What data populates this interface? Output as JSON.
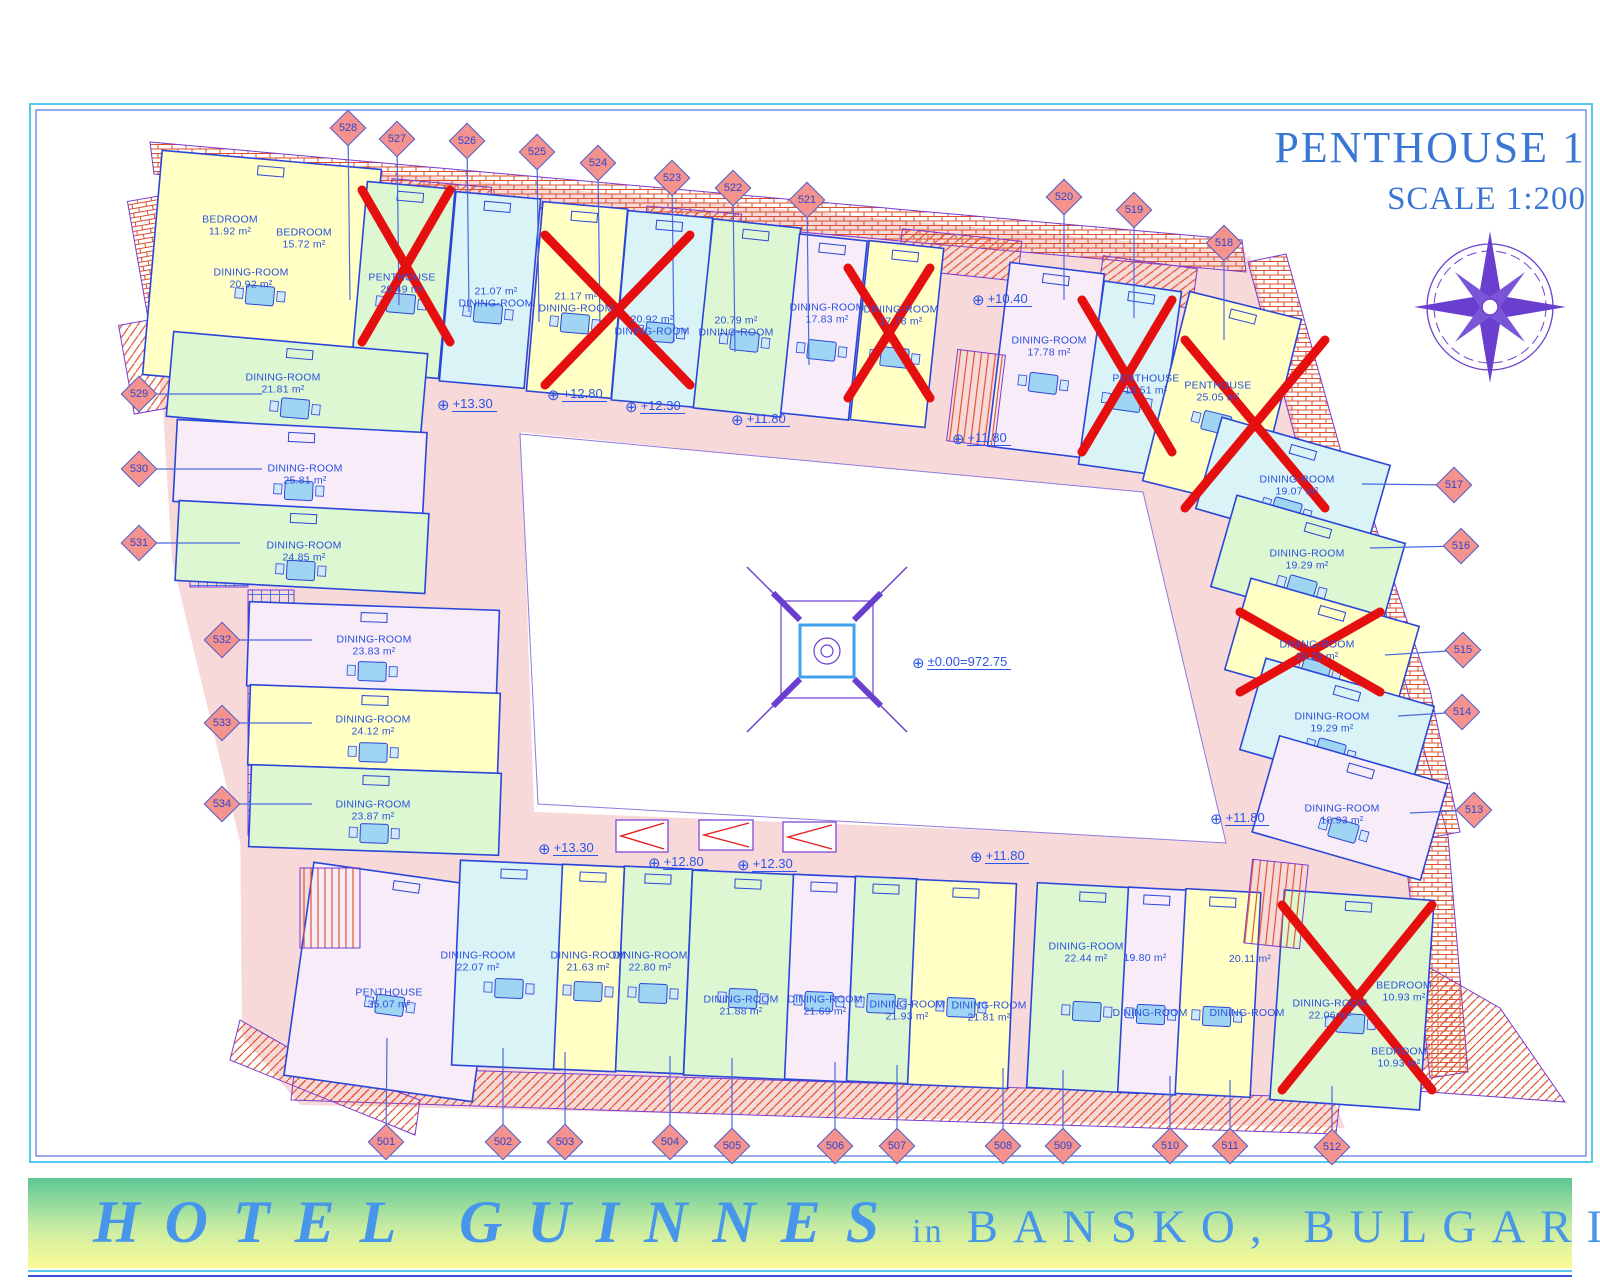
{
  "title": {
    "line1": "PENTHOUSE 1",
    "line2": "SCALE 1:200"
  },
  "banner": {
    "hotel": "HOTEL GUINNES",
    "conj": "in",
    "location": "BANSKO, BULGARIA"
  },
  "colors": {
    "corridor": "#f8d9d9",
    "yellow": "#ffffc6",
    "cyan": "#d9f3f6",
    "green": "#def7d3",
    "lavender": "#f7ecf8",
    "line": "#2a46d8",
    "label": "#2950e0",
    "red_cross": "#e60f0f",
    "roof_line": "#e0542e",
    "marker_fill": "#f4938d",
    "marker_border": "#4a5fd0",
    "compass": "#6a3fd0",
    "banner_text": "#4796ea",
    "title_text": "#3a76d6",
    "furniture": "#9fd4f2"
  },
  "center_atrium": {
    "icon": "atrium-skylight"
  },
  "compass_icon": "compass-rose",
  "elevations": [
    {
      "t": "+13.30",
      "x": 437,
      "y": 404
    },
    {
      "t": "+12.80",
      "x": 547,
      "y": 394
    },
    {
      "t": "+12.30",
      "x": 625,
      "y": 406
    },
    {
      "t": "+11.80",
      "x": 731,
      "y": 419
    },
    {
      "t": "+10.40",
      "x": 972,
      "y": 299
    },
    {
      "t": "+11.80",
      "x": 952,
      "y": 438
    },
    {
      "t": "±0.00=972.75",
      "x": 912,
      "y": 662
    },
    {
      "t": "+11.80",
      "x": 1210,
      "y": 818
    },
    {
      "t": "+13.30",
      "x": 538,
      "y": 848
    },
    {
      "t": "+12.80",
      "x": 648,
      "y": 862
    },
    {
      "t": "+12.30",
      "x": 737,
      "y": 864
    },
    {
      "t": "+11.80",
      "x": 970,
      "y": 856
    }
  ],
  "markers": [
    {
      "n": "528",
      "x": 348,
      "y": 128,
      "tx": 350,
      "ty": 300
    },
    {
      "n": "527",
      "x": 397,
      "y": 139,
      "tx": 399,
      "ty": 305
    },
    {
      "n": "526",
      "x": 467,
      "y": 141,
      "tx": 469,
      "ty": 312
    },
    {
      "n": "525",
      "x": 537,
      "y": 152,
      "tx": 539,
      "ty": 322
    },
    {
      "n": "524",
      "x": 598,
      "y": 163,
      "tx": 600,
      "ty": 330
    },
    {
      "n": "523",
      "x": 672,
      "y": 178,
      "tx": 674,
      "ty": 342
    },
    {
      "n": "522",
      "x": 733,
      "y": 188,
      "tx": 735,
      "ty": 352
    },
    {
      "n": "521",
      "x": 807,
      "y": 200,
      "tx": 809,
      "ty": 365
    },
    {
      "n": "520",
      "x": 1064,
      "y": 197,
      "tx": 1064,
      "ty": 300
    },
    {
      "n": "519",
      "x": 1134,
      "y": 210,
      "tx": 1134,
      "ty": 318
    },
    {
      "n": "518",
      "x": 1224,
      "y": 243,
      "tx": 1224,
      "ty": 340
    },
    {
      "n": "517",
      "x": 1454,
      "y": 485,
      "tx": 1362,
      "ty": 484
    },
    {
      "n": "516",
      "x": 1461,
      "y": 546,
      "tx": 1370,
      "ty": 548
    },
    {
      "n": "515",
      "x": 1463,
      "y": 650,
      "tx": 1385,
      "ty": 655
    },
    {
      "n": "514",
      "x": 1462,
      "y": 712,
      "tx": 1398,
      "ty": 716
    },
    {
      "n": "513",
      "x": 1474,
      "y": 810,
      "tx": 1410,
      "ty": 813
    },
    {
      "n": "529",
      "x": 139,
      "y": 394,
      "tx": 262,
      "ty": 394
    },
    {
      "n": "530",
      "x": 139,
      "y": 469,
      "tx": 262,
      "ty": 469
    },
    {
      "n": "531",
      "x": 139,
      "y": 543,
      "tx": 240,
      "ty": 543
    },
    {
      "n": "532",
      "x": 222,
      "y": 640,
      "tx": 312,
      "ty": 640
    },
    {
      "n": "533",
      "x": 222,
      "y": 723,
      "tx": 312,
      "ty": 723
    },
    {
      "n": "534",
      "x": 222,
      "y": 804,
      "tx": 312,
      "ty": 804
    },
    {
      "n": "501",
      "x": 386,
      "y": 1142,
      "tx": 387,
      "ty": 1038
    },
    {
      "n": "502",
      "x": 503,
      "y": 1142,
      "tx": 503,
      "ty": 1048
    },
    {
      "n": "503",
      "x": 565,
      "y": 1142,
      "tx": 565,
      "ty": 1052
    },
    {
      "n": "504",
      "x": 670,
      "y": 1142,
      "tx": 670,
      "ty": 1056
    },
    {
      "n": "505",
      "x": 732,
      "y": 1146,
      "tx": 732,
      "ty": 1058
    },
    {
      "n": "506",
      "x": 835,
      "y": 1146,
      "tx": 835,
      "ty": 1062
    },
    {
      "n": "507",
      "x": 897,
      "y": 1146,
      "tx": 897,
      "ty": 1065
    },
    {
      "n": "508",
      "x": 1003,
      "y": 1146,
      "tx": 1003,
      "ty": 1068
    },
    {
      "n": "509",
      "x": 1063,
      "y": 1146,
      "tx": 1063,
      "ty": 1070
    },
    {
      "n": "510",
      "x": 1170,
      "y": 1146,
      "tx": 1170,
      "ty": 1076
    },
    {
      "n": "511",
      "x": 1230,
      "y": 1146,
      "tx": 1230,
      "ty": 1080
    },
    {
      "n": "512",
      "x": 1332,
      "y": 1147,
      "tx": 1332,
      "ty": 1086
    }
  ],
  "labels": [
    {
      "t1": "BEDROOM",
      "t2": "11.92 m²",
      "x": 230,
      "y": 226
    },
    {
      "t1": "BEDROOM",
      "t2": "15.72 m²",
      "x": 304,
      "y": 239
    },
    {
      "t1": "DINING-ROOM",
      "t2": "20.92 m²",
      "x": 251,
      "y": 279
    },
    {
      "t1": "PENTHOUSE",
      "t2": "20.49 m²",
      "x": 402,
      "y": 284
    },
    {
      "t1": "21.07 m²",
      "t2": "DINING-ROOM",
      "x": 496,
      "y": 298
    },
    {
      "t1": "21.17 m²",
      "t2": "DINING-ROOM",
      "x": 576,
      "y": 303
    },
    {
      "t1": "20.92 m²",
      "t2": "DINING-ROOM",
      "x": 652,
      "y": 326
    },
    {
      "t1": "20.79 m²",
      "t2": "DINING-ROOM",
      "x": 736,
      "y": 327
    },
    {
      "t1": "DINING-ROOM",
      "t2": "17.83 m²",
      "x": 827,
      "y": 314
    },
    {
      "t1": "DINING-ROOM",
      "t2": "17.78 m²",
      "x": 901,
      "y": 316
    },
    {
      "t1": "DINING-ROOM",
      "t2": "17.78 m²",
      "x": 1049,
      "y": 347
    },
    {
      "t1": "PENTHOUSE",
      "t2": "18.51 m²",
      "x": 1146,
      "y": 385
    },
    {
      "t1": "PENTHOUSE",
      "t2": "25.05 m²",
      "x": 1218,
      "y": 392
    },
    {
      "t1": "DINING-ROOM",
      "t2": "19.07 m²",
      "x": 1297,
      "y": 486
    },
    {
      "t1": "DINING-ROOM",
      "t2": "19.29 m²",
      "x": 1307,
      "y": 560
    },
    {
      "t1": "DINING-ROOM",
      "t2": "19.29 m²",
      "x": 1317,
      "y": 651
    },
    {
      "t1": "DINING-ROOM",
      "t2": "19.29 m²",
      "x": 1332,
      "y": 723
    },
    {
      "t1": "DINING-ROOM",
      "t2": "18.93 m²",
      "x": 1342,
      "y": 815
    },
    {
      "t1": "DINING-ROOM",
      "t2": "21.81 m²",
      "x": 283,
      "y": 384
    },
    {
      "t1": "DINING-ROOM",
      "t2": "25.81 m²",
      "x": 305,
      "y": 475
    },
    {
      "t1": "DINING-ROOM",
      "t2": "24.85 m²",
      "x": 304,
      "y": 552
    },
    {
      "t1": "DINING-ROOM",
      "t2": "23.83 m²",
      "x": 374,
      "y": 646
    },
    {
      "t1": "DINING-ROOM",
      "t2": "24.12 m²",
      "x": 373,
      "y": 726
    },
    {
      "t1": "DINING-ROOM",
      "t2": "23.87 m²",
      "x": 373,
      "y": 811
    },
    {
      "t1": "PENTHOUSE",
      "t2": "35.07 m²",
      "x": 389,
      "y": 999
    },
    {
      "t1": "DINING-ROOM",
      "t2": "22.07 m²",
      "x": 478,
      "y": 962
    },
    {
      "t1": "DINING-ROOM",
      "t2": "21.63 m²",
      "x": 588,
      "y": 962
    },
    {
      "t1": "DINING-ROOM",
      "t2": "22.80 m²",
      "x": 650,
      "y": 962
    },
    {
      "t1": "DINING-ROOM",
      "t2": "21.88 m²",
      "x": 741,
      "y": 1006
    },
    {
      "t1": "DINING-ROOM",
      "t2": "21.69 m²",
      "x": 825,
      "y": 1006
    },
    {
      "t1": "DINING-ROOM",
      "t2": "21.93 m²",
      "x": 907,
      "y": 1011
    },
    {
      "t1": "DINING-ROOM",
      "t2": "21.81 m²",
      "x": 989,
      "y": 1012
    },
    {
      "t1": "DINING-ROOM",
      "t2": "22.44 m²",
      "x": 1086,
      "y": 953
    },
    {
      "t1": "19.80 m²",
      "t2": "",
      "x": 1145,
      "y": 958
    },
    {
      "t1": "DINING-ROOM",
      "t2": "",
      "x": 1150,
      "y": 1013
    },
    {
      "t1": "20.11 m²",
      "t2": "",
      "x": 1250,
      "y": 959
    },
    {
      "t1": "DINING-ROOM",
      "t2": "",
      "x": 1247,
      "y": 1013
    },
    {
      "t1": "DINING-ROOM",
      "t2": "22.06 m²",
      "x": 1330,
      "y": 1010
    },
    {
      "t1": "BEDROOM",
      "t2": "10.93 m²",
      "x": 1404,
      "y": 992
    },
    {
      "t1": "BEDROOM",
      "t2": "10.93 m²",
      "x": 1399,
      "y": 1058
    }
  ],
  "units": [
    {
      "cx": 262,
      "cy": 272,
      "w": 220,
      "h": 225,
      "rot": 5,
      "c": "yellow"
    },
    {
      "cx": 403,
      "cy": 280,
      "w": 88,
      "h": 190,
      "rot": 5,
      "c": "green"
    },
    {
      "cx": 490,
      "cy": 290,
      "w": 85,
      "h": 190,
      "rot": 5,
      "c": "cyan"
    },
    {
      "cx": 577,
      "cy": 300,
      "w": 85,
      "h": 190,
      "rot": 5,
      "c": "yellow"
    },
    {
      "cx": 662,
      "cy": 309,
      "w": 85,
      "h": 190,
      "rot": 5,
      "c": "cyan"
    },
    {
      "cx": 747,
      "cy": 318,
      "w": 88,
      "h": 190,
      "rot": 6,
      "c": "green"
    },
    {
      "cx": 824,
      "cy": 327,
      "w": 68,
      "h": 180,
      "rot": 6,
      "c": "lavender"
    },
    {
      "cx": 897,
      "cy": 334,
      "w": 75,
      "h": 180,
      "rot": 6,
      "c": "yellow"
    },
    {
      "cx": 1046,
      "cy": 360,
      "w": 95,
      "h": 185,
      "rot": 7,
      "c": "lavender"
    },
    {
      "cx": 1130,
      "cy": 378,
      "w": 78,
      "h": 185,
      "rot": 8,
      "c": "cyan"
    },
    {
      "cx": 1222,
      "cy": 400,
      "w": 115,
      "h": 195,
      "rot": 14,
      "c": "yellow"
    },
    {
      "cx": 1293,
      "cy": 487,
      "w": 175,
      "h": 95,
      "rot": 16,
      "c": "cyan"
    },
    {
      "cx": 1308,
      "cy": 565,
      "w": 175,
      "h": 95,
      "rot": 16,
      "c": "green"
    },
    {
      "cx": 1322,
      "cy": 648,
      "w": 175,
      "h": 95,
      "rot": 16,
      "c": "yellow"
    },
    {
      "cx": 1337,
      "cy": 728,
      "w": 175,
      "h": 95,
      "rot": 16,
      "c": "cyan"
    },
    {
      "cx": 1350,
      "cy": 808,
      "w": 175,
      "h": 100,
      "rot": 16,
      "c": "lavender"
    },
    {
      "cx": 297,
      "cy": 385,
      "w": 255,
      "h": 85,
      "rot": 5,
      "c": "green"
    },
    {
      "cx": 300,
      "cy": 467,
      "w": 250,
      "h": 82,
      "rot": 3,
      "c": "lavender"
    },
    {
      "cx": 302,
      "cy": 547,
      "w": 250,
      "h": 80,
      "rot": 3,
      "c": "green"
    },
    {
      "cx": 373,
      "cy": 648,
      "w": 250,
      "h": 84,
      "rot": 2,
      "c": "lavender"
    },
    {
      "cx": 374,
      "cy": 729,
      "w": 250,
      "h": 80,
      "rot": 2,
      "c": "yellow"
    },
    {
      "cx": 375,
      "cy": 810,
      "w": 250,
      "h": 82,
      "rot": 2,
      "c": "green"
    },
    {
      "cx": 393,
      "cy": 982,
      "w": 190,
      "h": 215,
      "rot": 8,
      "c": "lavender"
    },
    {
      "cx": 510,
      "cy": 965,
      "w": 108,
      "h": 205,
      "rot": 2.5,
      "c": "cyan"
    },
    {
      "cx": 589,
      "cy": 968,
      "w": 62,
      "h": 205,
      "rot": 2.5,
      "c": "yellow"
    },
    {
      "cx": 654,
      "cy": 970,
      "w": 68,
      "h": 205,
      "rot": 2.5,
      "c": "green"
    },
    {
      "cx": 744,
      "cy": 975,
      "w": 112,
      "h": 205,
      "rot": 2.5,
      "c": "green"
    },
    {
      "cx": 820,
      "cy": 978,
      "w": 62,
      "h": 205,
      "rot": 2.5,
      "c": "lavender"
    },
    {
      "cx": 882,
      "cy": 980,
      "w": 62,
      "h": 205,
      "rot": 2.5,
      "c": "green"
    },
    {
      "cx": 962,
      "cy": 984,
      "w": 100,
      "h": 205,
      "rot": 2.5,
      "c": "yellow"
    },
    {
      "cx": 1088,
      "cy": 988,
      "w": 112,
      "h": 205,
      "rot": 3,
      "c": "green"
    },
    {
      "cx": 1152,
      "cy": 991,
      "w": 58,
      "h": 205,
      "rot": 3,
      "c": "lavender"
    },
    {
      "cx": 1218,
      "cy": 993,
      "w": 75,
      "h": 205,
      "rot": 3,
      "c": "yellow"
    },
    {
      "cx": 1352,
      "cy": 1000,
      "w": 150,
      "h": 210,
      "rot": 4,
      "c": "green"
    }
  ],
  "crosses": [
    {
      "x1": 362,
      "y1": 190,
      "x2": 450,
      "y2": 342
    },
    {
      "x1": 545,
      "y1": 235,
      "x2": 690,
      "y2": 385
    },
    {
      "x1": 848,
      "y1": 268,
      "x2": 930,
      "y2": 398
    },
    {
      "x1": 1082,
      "y1": 300,
      "x2": 1172,
      "y2": 452
    },
    {
      "x1": 1185,
      "y1": 340,
      "x2": 1325,
      "y2": 508
    },
    {
      "x1": 1240,
      "y1": 612,
      "x2": 1380,
      "y2": 692
    },
    {
      "x1": 1282,
      "y1": 905,
      "x2": 1432,
      "y2": 1090
    }
  ]
}
